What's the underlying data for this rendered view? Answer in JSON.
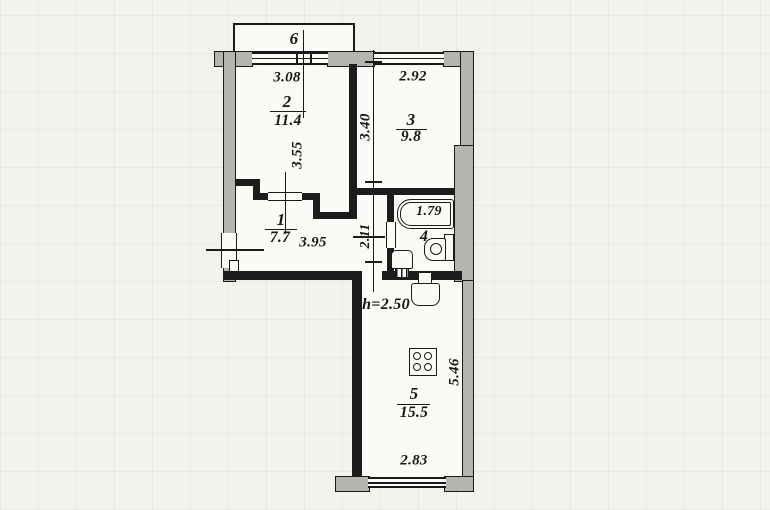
{
  "plan_type": "apartment floor plan",
  "rooms": {
    "balcony": {
      "number": "6"
    },
    "room2": {
      "number": "2",
      "area": "11.4"
    },
    "room3": {
      "number": "3",
      "area": "9.8"
    },
    "hall": {
      "number": "1",
      "area": "7.7"
    },
    "bathroom": {
      "number": "4"
    },
    "kitchen": {
      "number": "5",
      "area": "15.5"
    }
  },
  "dimensions": {
    "balcony_width": "3.08",
    "room2_depth": "3.55",
    "room3_width": "2.92",
    "room3_depth": "3.40",
    "hall_length": "3.95",
    "corridor_depth": "2.11",
    "bathtub_length": "1.79",
    "kitchen_depth": "5.46",
    "kitchen_window_width": "2.83",
    "ceiling_height": "h=2.50"
  },
  "fixtures": [
    "bathtub",
    "toilet",
    "washbasin",
    "kitchen-sink",
    "stove"
  ],
  "colors": {
    "paper": "#f3f2ed",
    "room_fill": "#fbfaf6",
    "wall_fill": "#b6b4af",
    "line": "#1a1a1a"
  }
}
